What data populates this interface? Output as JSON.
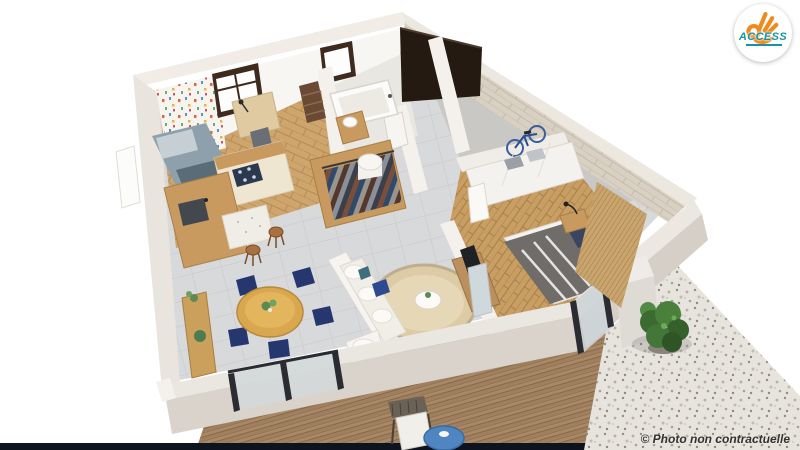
{
  "branding": {
    "logo_text": "ACCESS",
    "logo_icon": "ok-hand-icon"
  },
  "footer": {
    "copyright": "© Photo non contractuelle"
  },
  "colors": {
    "logo_orange": "#f08a1d",
    "logo_teal": "#1793a6",
    "wall_stone": "#d8d0c2",
    "interior_wall": "#f6f4f0",
    "tile_floor": "#d8d9db",
    "wood_floor": "#cda56d",
    "deck_wood": "#a98866",
    "gravel": "#e7e4de",
    "garage_concrete": "#c9c8c4",
    "garage_door": "#241a12",
    "accent_navy_chairs": "#26366e",
    "bed_duvet_gray": "#6f6c6a",
    "dining_table_wood": "#d9a84e",
    "bottom_strip": "#0d1420",
    "shrub_green": "#49803c"
  },
  "scene": {
    "type": "3d-floorplan-render",
    "rooms": [
      "child-bedroom",
      "kitchen",
      "dining-area",
      "living-room",
      "bathroom",
      "dressing-hallway",
      "garage",
      "master-bedroom",
      "terrace-deck",
      "gravel-yard"
    ],
    "objects": [
      "child-bed",
      "desk-and-chair",
      "wallpaper-accent-wall",
      "kitchen-counter-cooktop",
      "kitchen-island-sink",
      "bar-stools",
      "wood-sideboard",
      "dining-table",
      "dining-chairs",
      "sofa",
      "round-rug",
      "coffee-table",
      "tv-console",
      "bathtub",
      "vanity-sink",
      "ladder-shelf",
      "wardrobe-clothes-rail",
      "laundry-basket",
      "garage-door",
      "bicycle",
      "garage-sideboard-towels",
      "master-bed",
      "nightstand-lamp",
      "bedroom-wardrobe",
      "mirror-door",
      "rattan-headboard-wall",
      "sliding-glass-doors",
      "outdoor-chair",
      "blue-side-table",
      "shrub"
    ]
  }
}
